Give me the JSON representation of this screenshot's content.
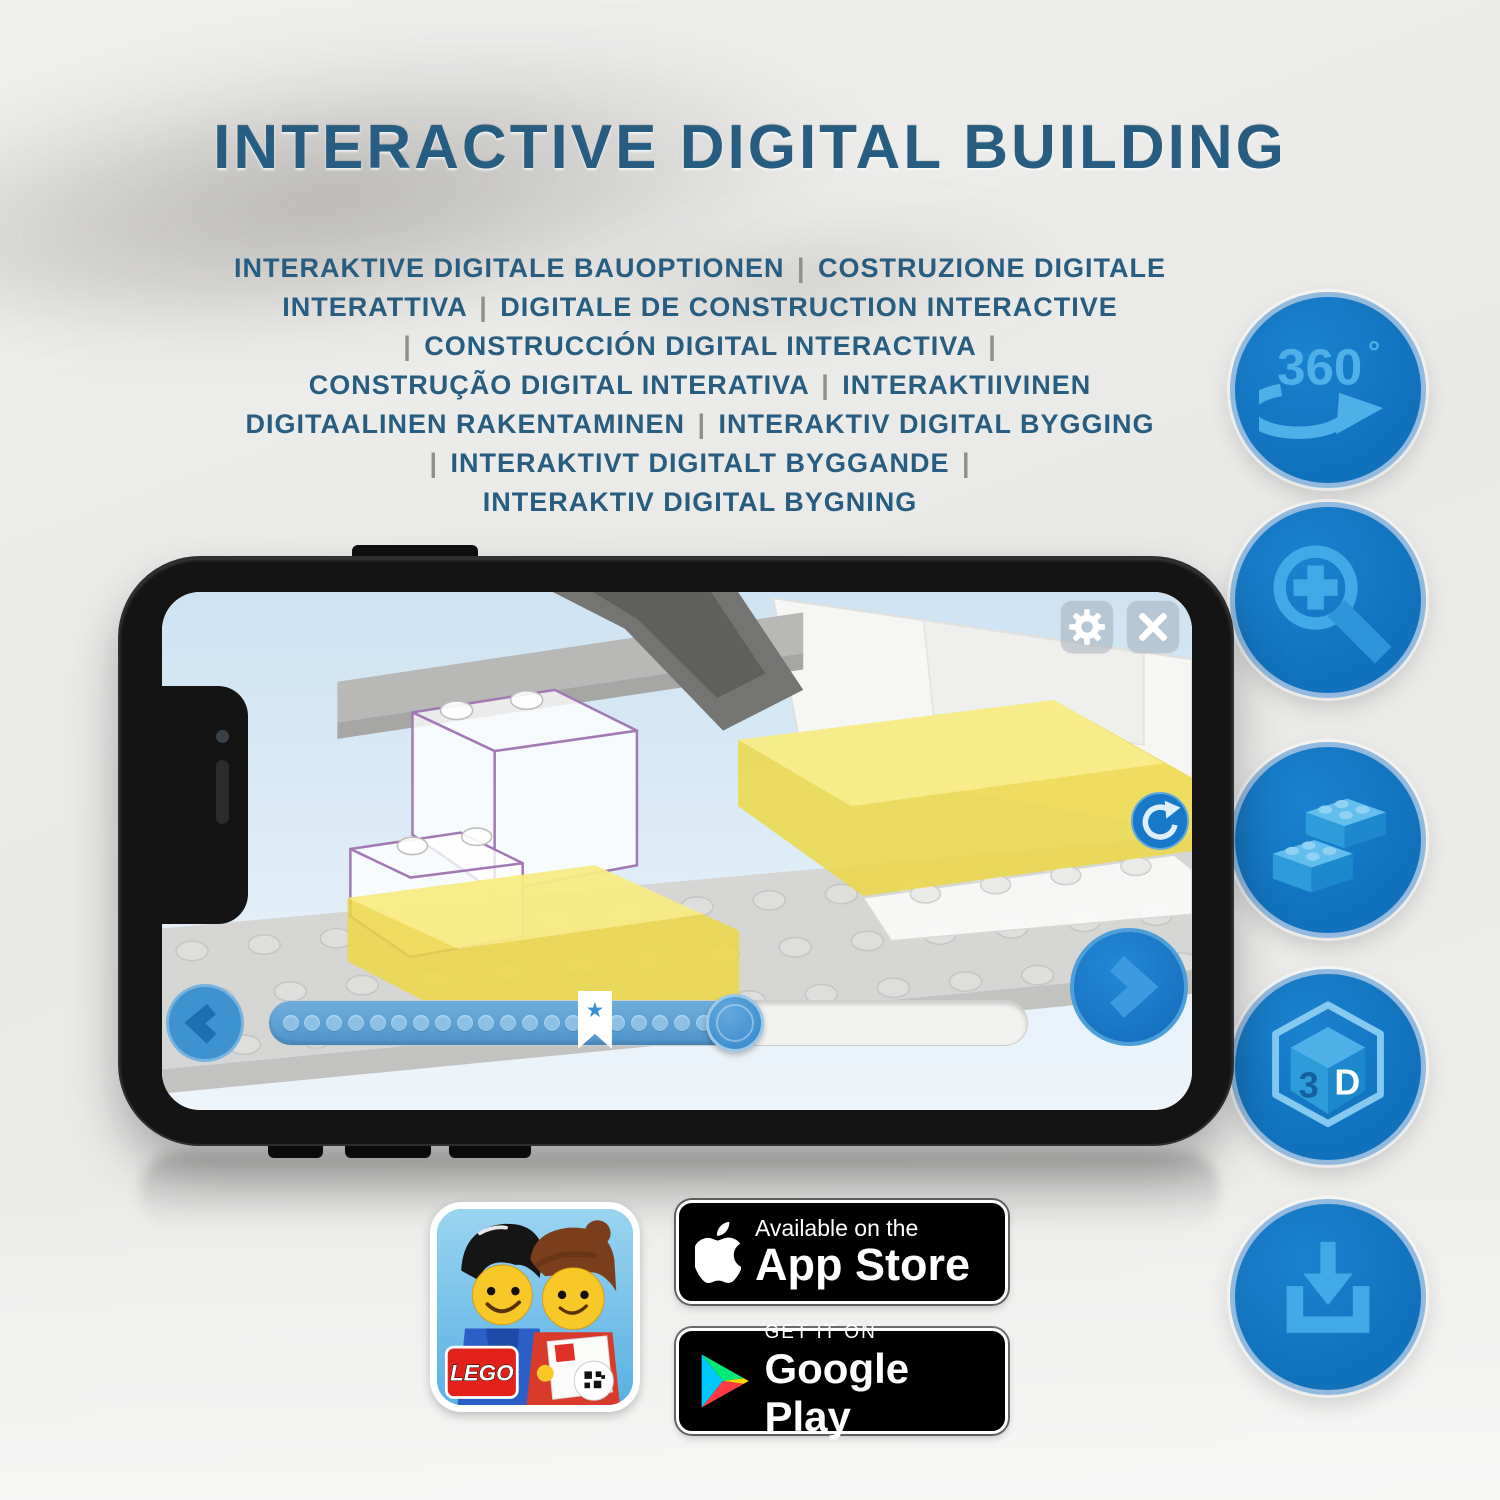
{
  "title": {
    "text": "INTERACTIVE DIGITAL BUILDING"
  },
  "subtitle": {
    "lines": [
      "INTERAKTIVE DIGITALE BAUOPTIONEN | COSTRUZIONE DIGITALE",
      "INTERATTIVA | DIGITALE DE CONSTRUCTION INTERACTIVE",
      "| CONSTRUCCIÓN DIGITAL INTERACTIVA |",
      "CONSTRUÇÃO DIGITAL INTERATIVA | INTERAKTIIVINEN",
      "DIGITAALINEN RAKENTAMINEN | INTERAKTIV DIGITAL BYGGING",
      "| INTERAKTIVT DIGITALT BYGGANDE |",
      "INTERAKTIV DIGITAL BYGNING"
    ]
  },
  "feature_icons": {
    "rotation": {
      "number": "360",
      "degree": "°"
    },
    "cube": {
      "left_face": "3",
      "right_face": "D"
    }
  },
  "store": {
    "app_store": {
      "tagline": "Available on the",
      "name": "App Store"
    },
    "google_play": {
      "tagline": "GET IT ON",
      "name": "Google Play"
    },
    "lego_logo": "LEGO"
  },
  "phone_ui": {
    "progress": {
      "dot_count": 20,
      "dot_start_pct": 1.8,
      "dot_step_pct": 2.87,
      "fill_pct": 64,
      "handle_pct": 61.5,
      "star_pct": 43
    }
  },
  "colors": {
    "title_blue": "#265D80",
    "badge_circle_blue": "#1071BC",
    "glyph_blue": "#41A9E6",
    "ui_blue": "#1878C8",
    "brick_yellow": "#ECD847"
  }
}
